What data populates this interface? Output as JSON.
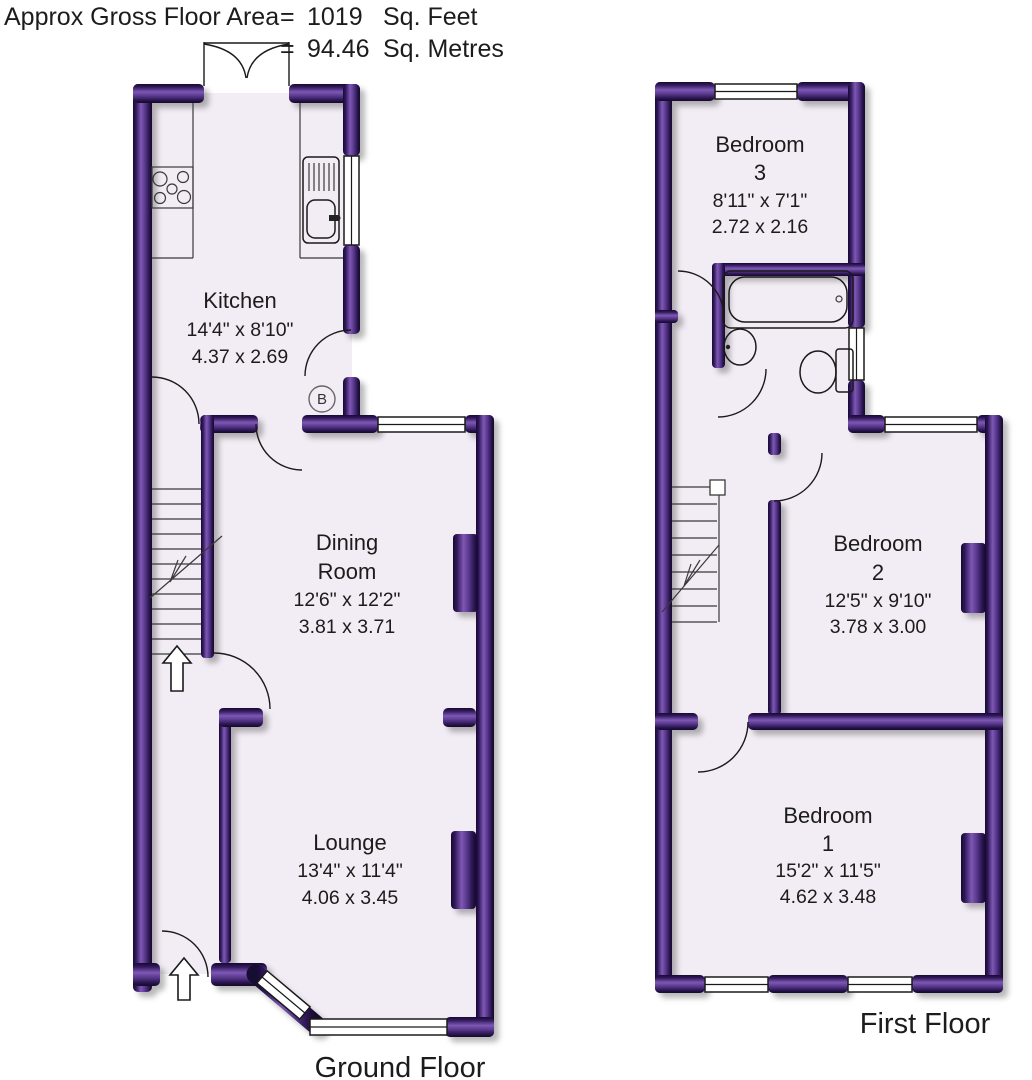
{
  "header": {
    "label": "Approx Gross Floor Area",
    "equals": "=",
    "sqft_value": "1019",
    "sqft_unit": "Sq. Feet",
    "sqm_value": "94.46",
    "sqm_unit": "Sq. Metres"
  },
  "ground_floor": {
    "label": "Ground Floor",
    "boiler": "B",
    "kitchen": {
      "name": "Kitchen",
      "imperial": "14'4\" x 8'10\"",
      "metric": "4.37 x 2.69"
    },
    "dining": {
      "name_line1": "Dining",
      "name_line2": "Room",
      "imperial": "12'6\" x 12'2\"",
      "metric": "3.81 x 3.71"
    },
    "lounge": {
      "name": "Lounge",
      "imperial": "13'4\" x 11'4\"",
      "metric": "4.06 x 3.45"
    }
  },
  "first_floor": {
    "label": "First Floor",
    "bedroom3": {
      "name": "Bedroom",
      "number": "3",
      "imperial": "8'11\" x 7'1\"",
      "metric": "2.72 x 2.16"
    },
    "bedroom2": {
      "name": "Bedroom",
      "number": "2",
      "imperial": "12'5\" x 9'10\"",
      "metric": "3.78 x 3.00"
    },
    "bedroom1": {
      "name": "Bedroom",
      "number": "1",
      "imperial": "15'2\" x 11'5\"",
      "metric": "4.62 x 3.48"
    }
  },
  "colors": {
    "wall_dark": "#1a0b33",
    "wall_highlight": "#7e58b4",
    "floor_fill": "#f2edf4",
    "outline": "#1a1a1a"
  }
}
